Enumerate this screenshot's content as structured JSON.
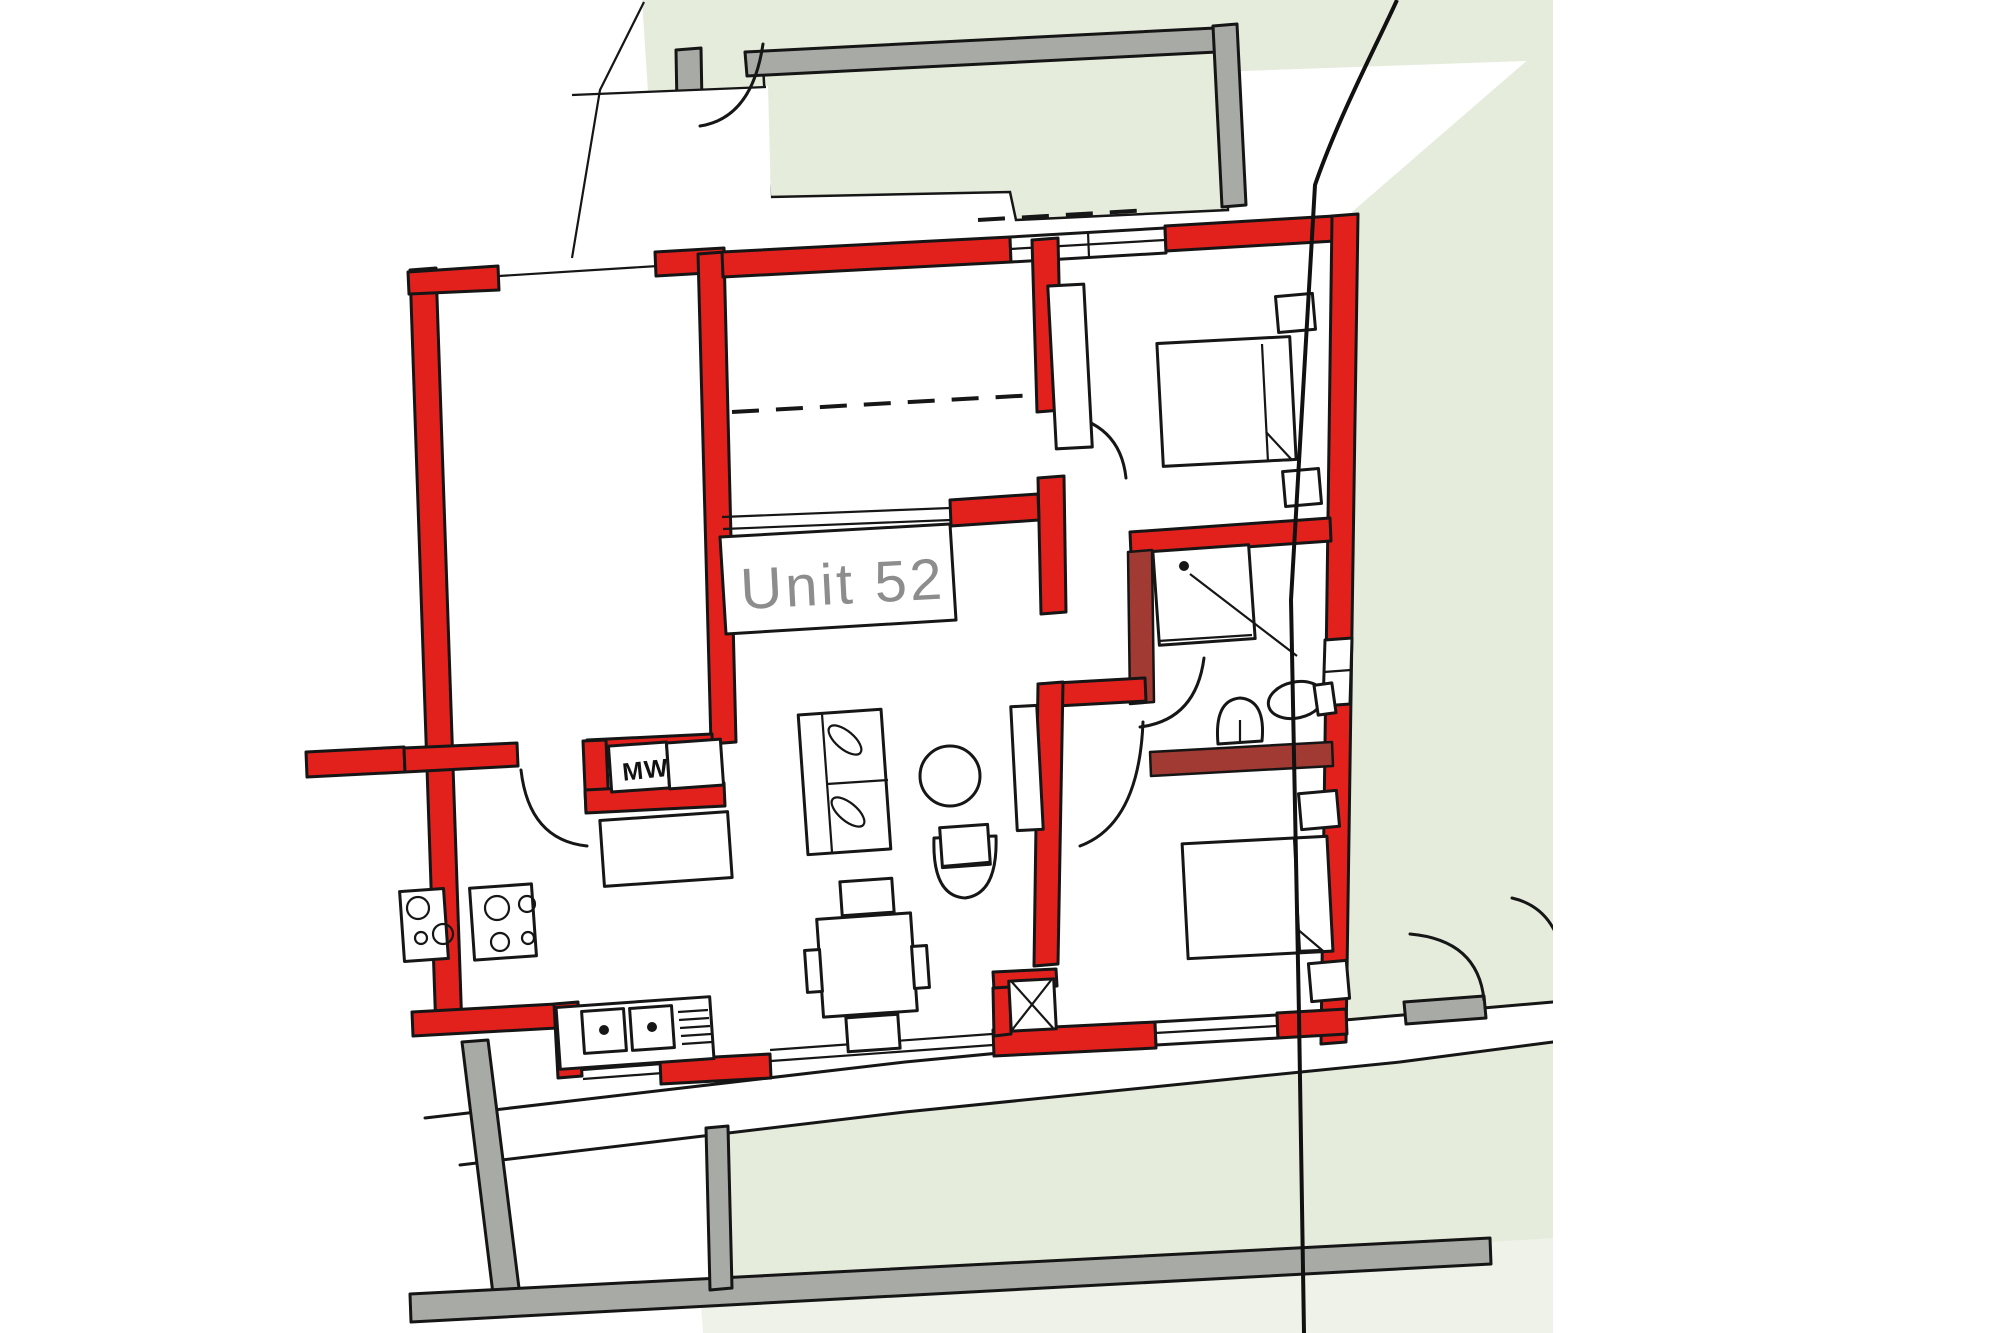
{
  "plan": {
    "unit_label": "Unit 52",
    "microwave_label": "MW"
  },
  "colors": {
    "unit_wall_red": "#e2211d",
    "interior_wall_maroon": "#a03a33",
    "communal_wall_gray": "#a8aaa5",
    "outdoor_green": "#e5ecdc",
    "outdoor_green_pale": "#eef2e8",
    "line_black": "#161616",
    "label_text_gray": "#8d8d8d",
    "page_background": "#ffffff"
  },
  "legend": {
    "rooms": [
      "entry-lobby",
      "storage-room",
      "kitchen",
      "dining-area",
      "living-room",
      "hallway",
      "bathroom",
      "bedroom-1",
      "bedroom-2",
      "terrace",
      "garden",
      "walkway"
    ],
    "furniture": [
      "sofa",
      "coffee-table",
      "tub-chair",
      "dining-table",
      "dining-chairs",
      "cooktop",
      "kitchen-sink",
      "microwave",
      "kitchen-counter",
      "shower",
      "washbasin",
      "toilet",
      "bed",
      "nightstand",
      "wardrobe",
      "service-shaft"
    ]
  }
}
